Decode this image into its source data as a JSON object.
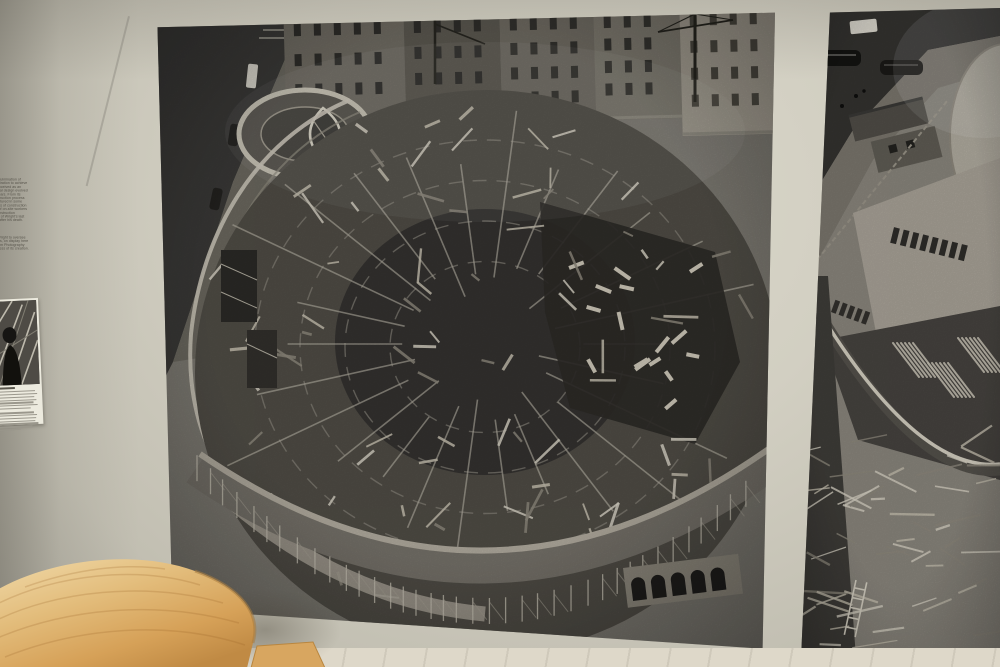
{
  "scene": {
    "setting": "museum gallery wall with construction photographs of the Guggenheim Museum",
    "wall_color": "#d2cfc2",
    "gap_color": "#dedbd0",
    "floor_color": "#ded8c9",
    "table_wood_color": "#dcaa61",
    "photo_tone_dark": "#3a3937",
    "photo_tone_light": "#cfcabd"
  },
  "wall_label": {
    "paragraph1_lines": [
      "omon R. Guggenheim Museum is the culmination of",
      "ican architect Frank Lloyd Wright's aspiration to achieve",
      "al continuity in built form. Originally conceived as an",
      "nt, even elegant, the building's structural design evolved",
      "as refined considerably over sixteen years. From its",
      "tion in 1943 through a three-year construction process",
      "an in 1956, Wright's daring design, captured in some",
      "e hundred sketches and in different sets of construction",
      "ngs, ultimately relied on the ingenuity of on-site workers",
      "ed by intentions through pioneering construction",
      "ques. The celebrated building was one of Wright's last",
      "ning on October 21, 1959, six months after his death."
    ],
    "paragraph2_lines": [
      "ect William H. Short was selected by Wright to oversee",
      "building's construction. His photographs, on display here",
      "m the Solomon R. Guggenheim Museum Photography",
      "ive, document the unprecedented process of its creation."
    ],
    "credit_bar_widths": [
      66,
      60,
      22
    ]
  },
  "caption_card": {
    "photo_description": "small black-and-white photograph of a man at the construction site",
    "caption_bar_widths": [
      18,
      38,
      40,
      37,
      39,
      36,
      40,
      33,
      0,
      36,
      39,
      38,
      37,
      40,
      34,
      22
    ]
  },
  "main_photo": {
    "description": "large black-and-white aerial photograph of the Guggenheim Museum rotunda under construction, dense wooden scaffolding and formwork, small round monitor building at upper left, Fifth Avenue with parked cars and brownstone buildings at top"
  },
  "right_photo": {
    "description": "partially visible black-and-white aerial photograph of the construction site, street with vintage cars and sheds above the curved museum structure wrapped in scaffolding"
  },
  "table": {
    "description": "light wood organically shaped table in the foreground"
  }
}
